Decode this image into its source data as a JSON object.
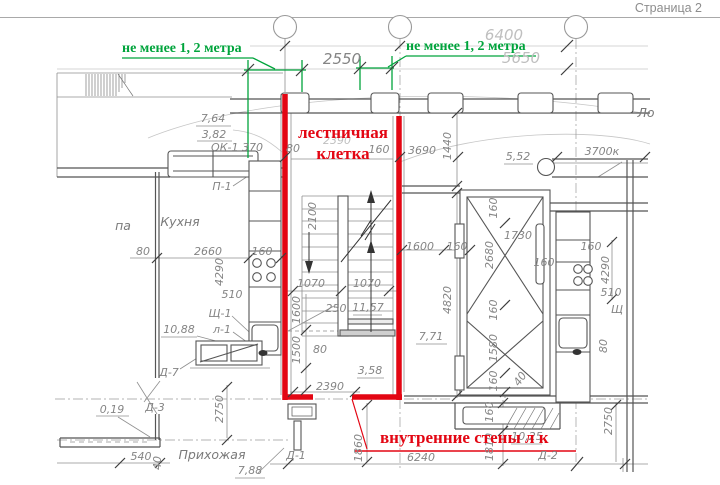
{
  "page": {
    "label": "Страница 2"
  },
  "colors": {
    "red_accent": "#e30613",
    "green_accent": "#00a43c",
    "dim_gray": "#858585",
    "wall_gray": "#555555"
  },
  "annotations": {
    "green_left": "не менее 1, 2 метра",
    "green_right": "не менее 1, 2 метра",
    "stair_label_line1": "лестничная",
    "stair_label_line2": "клетка",
    "inner_walls": "внутренние стены л к"
  },
  "drawing": {
    "rooms": [
      "Кухня",
      "Прихожая"
    ],
    "marks": [
      "ОК-1",
      "П-1",
      "Щ-1",
      "л-1",
      "Д-1",
      "Д-2",
      "Д-3",
      "Д-7"
    ],
    "elevations": [
      "7,64",
      "3,82",
      "5,52",
      "10,88",
      "11,57",
      "3,58",
      "7,71",
      "7,88",
      "10,25",
      "0,19"
    ],
    "labels": [
      {
        "t": "6400",
        "x": 504,
        "y": 40,
        "c": "faint big"
      },
      {
        "t": "2550",
        "x": 342,
        "y": 64,
        "c": "big"
      },
      {
        "t": "5650",
        "x": 521,
        "y": 63,
        "c": "faint big"
      },
      {
        "t": "7,64",
        "x": 213,
        "y": 122
      },
      {
        "t": "3,82",
        "x": 214,
        "y": 138
      },
      {
        "t": "ОК-1 370",
        "x": 237,
        "y": 151
      },
      {
        "t": "80",
        "x": 293,
        "y": 152
      },
      {
        "t": "2390",
        "x": 337,
        "y": 144,
        "c": "faint"
      },
      {
        "t": "160",
        "x": 379,
        "y": 153
      },
      {
        "t": "3690",
        "x": 422,
        "y": 154
      },
      {
        "t": "1440",
        "x": 451,
        "y": 146,
        "r": -90
      },
      {
        "t": "5,52",
        "x": 518,
        "y": 160
      },
      {
        "t": "3700к",
        "x": 602,
        "y": 155
      },
      {
        "t": "Ло",
        "x": 646,
        "y": 117,
        "c": "room"
      },
      {
        "t": "П-1",
        "x": 222,
        "y": 190
      },
      {
        "t": "Кухня",
        "x": 180,
        "y": 226,
        "c": "room"
      },
      {
        "t": "па",
        "x": 123,
        "y": 230,
        "c": "room"
      },
      {
        "t": "80",
        "x": 143,
        "y": 255
      },
      {
        "t": "2660",
        "x": 208,
        "y": 255
      },
      {
        "t": "160",
        "x": 262,
        "y": 255
      },
      {
        "t": "4290",
        "x": 223,
        "y": 272,
        "r": -90
      },
      {
        "t": "510",
        "x": 232,
        "y": 298
      },
      {
        "t": "Щ-1",
        "x": 220,
        "y": 317
      },
      {
        "t": "л-1",
        "x": 222,
        "y": 333
      },
      {
        "t": "10,88",
        "x": 179,
        "y": 333
      },
      {
        "t": "Д-7",
        "x": 169,
        "y": 376
      },
      {
        "t": "0,19",
        "x": 112,
        "y": 413
      },
      {
        "t": "Д-3",
        "x": 155,
        "y": 411
      },
      {
        "t": "540",
        "x": 141,
        "y": 460
      },
      {
        "t": "40",
        "x": 161,
        "y": 463,
        "r": -90
      },
      {
        "t": "Прихожая",
        "x": 212,
        "y": 459,
        "c": "room"
      },
      {
        "t": "7,88",
        "x": 250,
        "y": 474
      },
      {
        "t": "2750",
        "x": 223,
        "y": 409,
        "r": -90
      },
      {
        "t": "Д-1",
        "x": 296,
        "y": 459
      },
      {
        "t": "1860",
        "x": 362,
        "y": 448,
        "r": -90
      },
      {
        "t": "6240",
        "x": 421,
        "y": 461
      },
      {
        "t": "10,25",
        "x": 527,
        "y": 440
      },
      {
        "t": "Д-2",
        "x": 548,
        "y": 459
      },
      {
        "t": "1810",
        "x": 493,
        "y": 447,
        "r": -90
      },
      {
        "t": "160",
        "x": 493,
        "y": 412,
        "r": -90
      },
      {
        "t": "2750",
        "x": 612,
        "y": 421,
        "r": -90
      },
      {
        "t": "7,71",
        "x": 431,
        "y": 340
      },
      {
        "t": "4820",
        "x": 451,
        "y": 300,
        "r": -90
      },
      {
        "t": "1600",
        "x": 420,
        "y": 250
      },
      {
        "t": "160",
        "x": 457,
        "y": 250
      },
      {
        "t": "160",
        "x": 497,
        "y": 208,
        "r": -90
      },
      {
        "t": "2680",
        "x": 493,
        "y": 255,
        "r": -90
      },
      {
        "t": "1730",
        "x": 518,
        "y": 239
      },
      {
        "t": "160",
        "x": 544,
        "y": 266
      },
      {
        "t": "160",
        "x": 591,
        "y": 250
      },
      {
        "t": "4290",
        "x": 609,
        "y": 270,
        "r": -90
      },
      {
        "t": "510",
        "x": 611,
        "y": 296
      },
      {
        "t": "160",
        "x": 497,
        "y": 310,
        "r": -90
      },
      {
        "t": "1580",
        "x": 497,
        "y": 348,
        "r": -90
      },
      {
        "t": "160",
        "x": 497,
        "y": 381,
        "r": -90
      },
      {
        "t": "40",
        "x": 523,
        "y": 381,
        "r": -55
      },
      {
        "t": "Щ",
        "x": 617,
        "y": 313
      },
      {
        "t": "80",
        "x": 607,
        "y": 346,
        "r": -90
      },
      {
        "t": "2100",
        "x": 316,
        "y": 216,
        "r": -90
      },
      {
        "t": "1070",
        "x": 311,
        "y": 287
      },
      {
        "t": "1070",
        "x": 367,
        "y": 287
      },
      {
        "t": "1600",
        "x": 300,
        "y": 310,
        "r": -90
      },
      {
        "t": "250",
        "x": 336,
        "y": 312
      },
      {
        "t": "11,57",
        "x": 368,
        "y": 311
      },
      {
        "t": "1500",
        "x": 300,
        "y": 350,
        "r": -90
      },
      {
        "t": "80",
        "x": 320,
        "y": 353
      },
      {
        "t": "3,58",
        "x": 370,
        "y": 374
      },
      {
        "t": "2390",
        "x": 330,
        "y": 390
      }
    ]
  }
}
